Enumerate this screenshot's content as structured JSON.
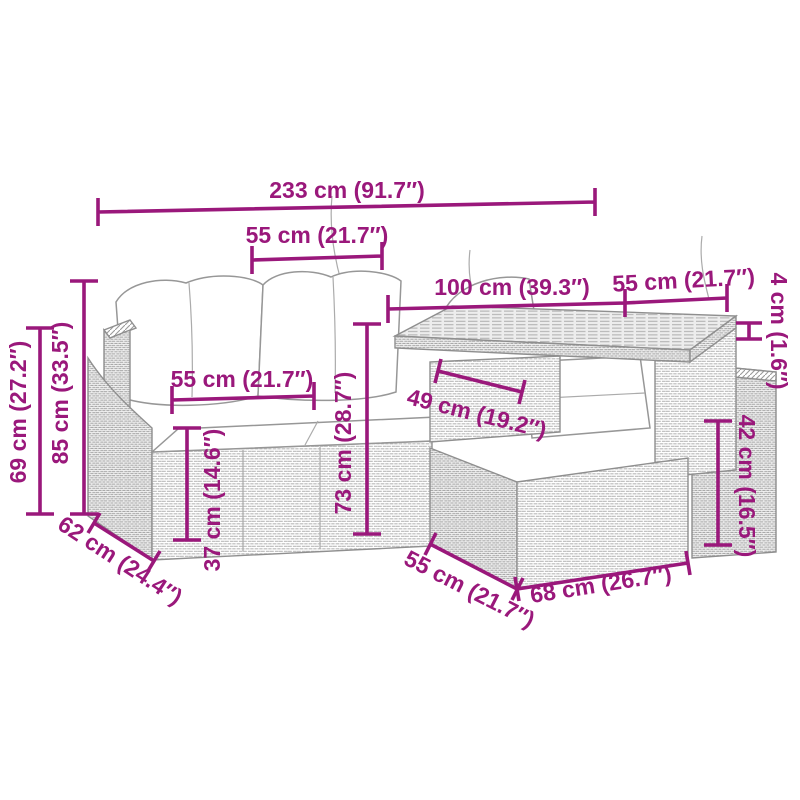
{
  "page": {
    "background": "#ffffff",
    "accent_color": "#9a187b",
    "artwork_line_color": "#8f8f8f",
    "subject": "garden-rattan-sofa-set-with-table-dimension-diagram"
  },
  "dimensions": {
    "total_width": {
      "label": "233 cm (91.7″)"
    },
    "backrest_width": {
      "label": "55 cm (21.7″)"
    },
    "table_length": {
      "label": "100 cm (39.3″)"
    },
    "table_extension": {
      "label": "55 cm (21.7″)"
    },
    "tabletop_thickness": {
      "label": "4 cm (1.6″)"
    },
    "total_height": {
      "label": "85 cm (33.5″)"
    },
    "armrest_height": {
      "label": "69 cm (27.2″)"
    },
    "seat_width": {
      "label": "55 cm (21.7″)"
    },
    "seat_height": {
      "label": "37 cm (14.6″)"
    },
    "backrest_height": {
      "label": "73 cm (28.7″)"
    },
    "under_table_clearance": {
      "label": "49 cm (19.2″)"
    },
    "table_base_height": {
      "label": "42 cm (16.5″)"
    },
    "sofa_depth": {
      "label": "62 cm (24.4″)"
    },
    "table_depth": {
      "label": "55 cm (21.7″)"
    },
    "table_base_length": {
      "label": "68 cm (26.7″)"
    }
  }
}
